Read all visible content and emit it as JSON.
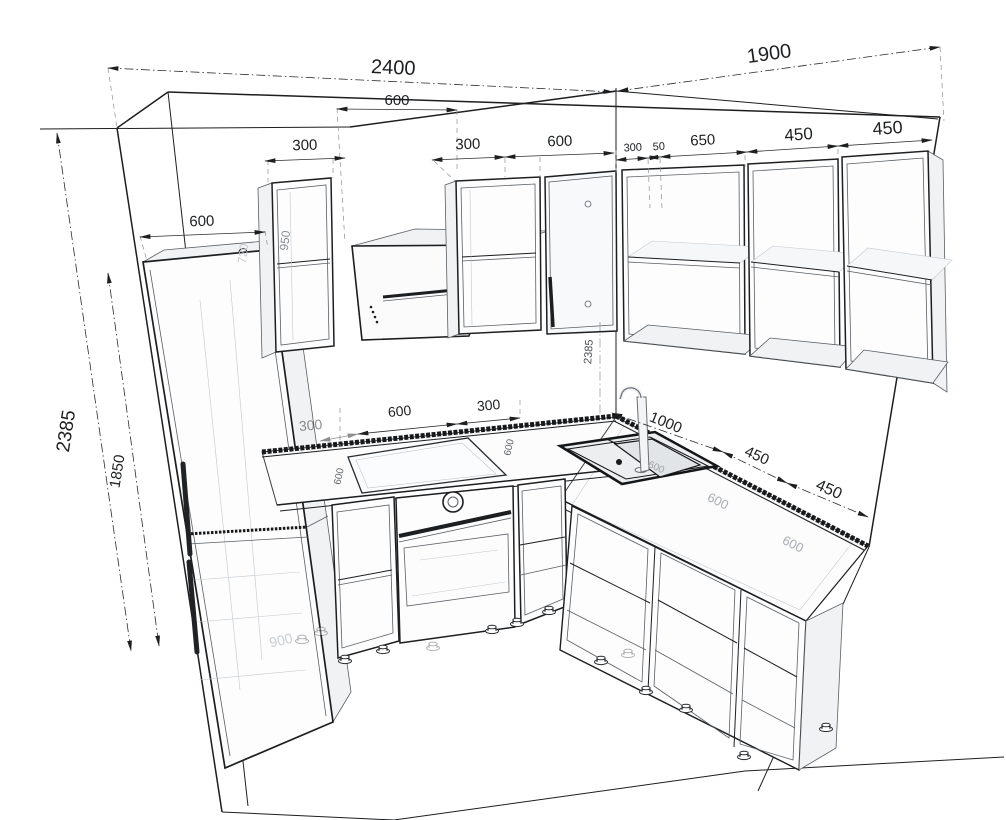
{
  "drawing": {
    "colors": {
      "line": "#1c1e20",
      "dimension": "#2a2c2e",
      "ghost": "#c3c8cc",
      "backsplash": "#17191b",
      "background": "#ffffff"
    },
    "dims": {
      "wall_left_total": "2400",
      "wall_right_total": "1900",
      "hood_span": "600",
      "upper_left_cab1": "300",
      "upper_left_cab2": "300",
      "upper_left_cab3": "600",
      "upper_right_offset": "300",
      "upper_right_gap": "50",
      "upper_right_cab1": "650",
      "upper_right_cab2": "450",
      "upper_right_cab3": "450",
      "fridge_width": "600",
      "room_height": "2385",
      "fridge_height": "1850",
      "wall_cab_height": "950",
      "fridge_top_clearance": "720",
      "corner_wall_height": "2385",
      "base_left_filler": "300",
      "base_hob_width": "600",
      "base_right_of_hob": "300",
      "sink_run_length": "1000",
      "base_right_cab1": "450",
      "base_right_cab2": "450",
      "counter_depth_a": "600",
      "counter_depth_b": "600",
      "counter_depth_c": "600",
      "counter_depth_d": "600",
      "counter_depth_e": "600",
      "fridge_niche_width": "900"
    }
  }
}
